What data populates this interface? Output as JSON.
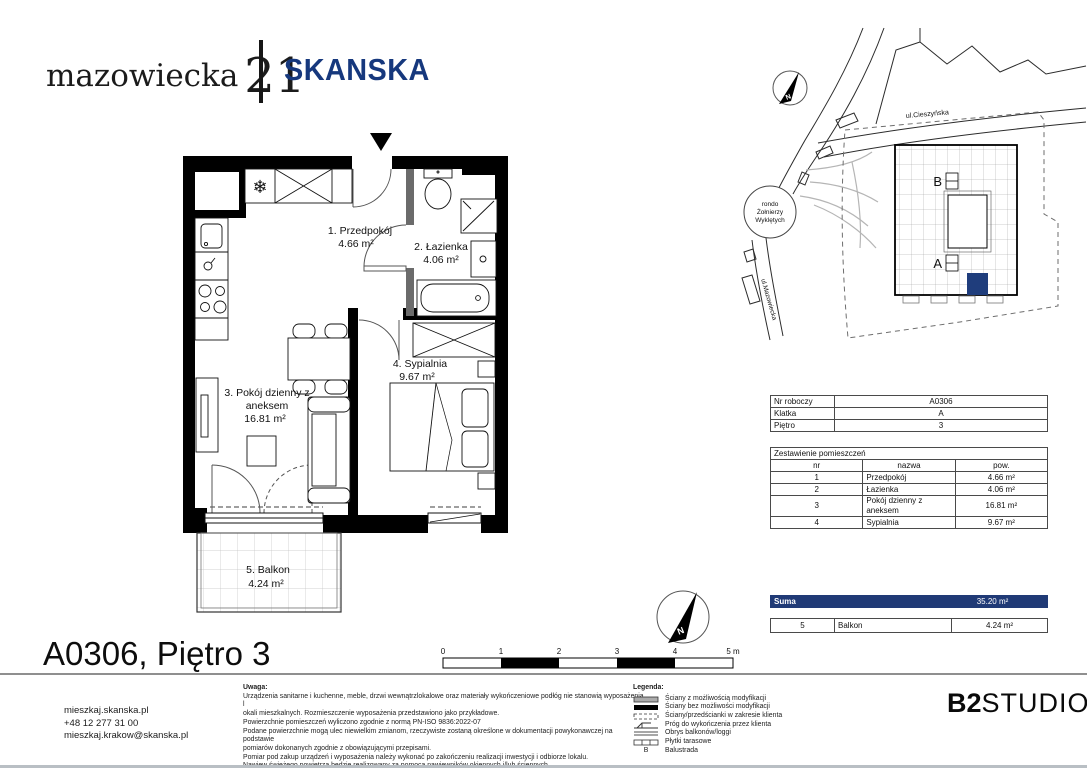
{
  "header": {
    "brand_name": "mazowiecka",
    "brand_number": "21",
    "company": "SKANSKA"
  },
  "colors": {
    "skanska_blue": "#16387d",
    "suma_bar": "#203a76",
    "unit_highlight": "#1f3d7c"
  },
  "plan": {
    "rooms": {
      "r1": [
        "1. Przedpokój",
        "4.66 m²"
      ],
      "r2": [
        "2. Łazienka",
        "4.06 m²"
      ],
      "r3": [
        "3. Pokój dzienny z",
        "aneksem",
        "16.81 m²"
      ],
      "r4": [
        "4. Sypialnia",
        "9.67 m²"
      ],
      "r5": [
        "5. Balkon",
        "4.24 m²"
      ]
    }
  },
  "site_map": {
    "north_label": "N",
    "street_top": "ul.Cieszyńska",
    "street_left": "ul.Mazowiecka",
    "roundabout": [
      "rondo",
      "Żołnierzy",
      "Wyklętych"
    ],
    "stair_b": "B",
    "stair_a": "A"
  },
  "info_table": {
    "rows": [
      {
        "label": "Nr roboczy",
        "value": "A0306"
      },
      {
        "label": "Klatka",
        "value": "A"
      },
      {
        "label": "Piętro",
        "value": "3"
      }
    ]
  },
  "rooms_table": {
    "title": "Zestawienie pomieszczeń",
    "headers": [
      "nr",
      "nazwa",
      "pow."
    ],
    "rows": [
      [
        "1",
        "Przedpokój",
        "4.66 m²"
      ],
      [
        "2",
        "Łazienka",
        "4.06 m²"
      ],
      [
        "3",
        "Pokój dzienny z aneksem",
        "16.81 m²"
      ],
      [
        "4",
        "Sypialnia",
        "9.67 m²"
      ]
    ]
  },
  "suma": {
    "label": "Suma",
    "value": "35.20 m²"
  },
  "balcony_row": [
    "5",
    "Balkon",
    "4.24 m²"
  ],
  "title_block": {
    "title": "A0306, Piętro 3"
  },
  "contact": [
    "mieszkaj.skanska.pl",
    "+48 12 277 31 00",
    "mieszkaj.krakow@skanska.pl"
  ],
  "notes": {
    "title": "Uwaga:",
    "lines": [
      "Urządzenia sanitarne i kuchenne, meble, drzwi wewnątrzlokalowe oraz materiały wykończeniowe podłóg nie stanowią wyposażenia l",
      "okali mieszkalnych. Rozmieszczenie wyposażenia przedstawiono jako przykładowe.",
      "Powierzchnie pomieszczeń wyliczono zgodnie z normą PN-ISO 9836:2022-07",
      "Podane powierzchnie mogą ulec niewielkim zmianom, rzeczywiste zostaną określone w dokumentacji powykonawczej na podstawie",
      "pomiarów dokonanych zgodnie z obowiązującymi przepisami.",
      "Pomiar pod zakup urządzeń i wyposażenia należy wykonać po zakończeniu realizacji inwestycji i odbiorze lokalu.",
      "Nawiew świeżego powietrza będzie realizowany za pomocą nawiewników okiennych i/lub ściennych.",
      "Podłączenie instalacji wod.-kan. od podejścia ZW,CW,K bezpośrednio do urządzeń sanitarnych leży po stronie klienta."
    ]
  },
  "legend": {
    "title": "Legenda:",
    "items": [
      "Ściany z możliwością modyfikacji",
      "Ściany bez możliwości modyfikacji",
      "Ściany/przedścianki w zakresie klienta",
      "Próg do wykończenia przez klienta",
      "Obrys balkonów/loggi",
      "Płytki tarasowe",
      "Balustrada"
    ],
    "balustrade_symbol": "B"
  },
  "scale_bar": {
    "ticks": [
      "0",
      "1",
      "2",
      "3",
      "4"
    ],
    "end": "5 m"
  },
  "compass": {
    "label": "N"
  },
  "studio": {
    "bold": "B2",
    "light": "STUDIO"
  }
}
